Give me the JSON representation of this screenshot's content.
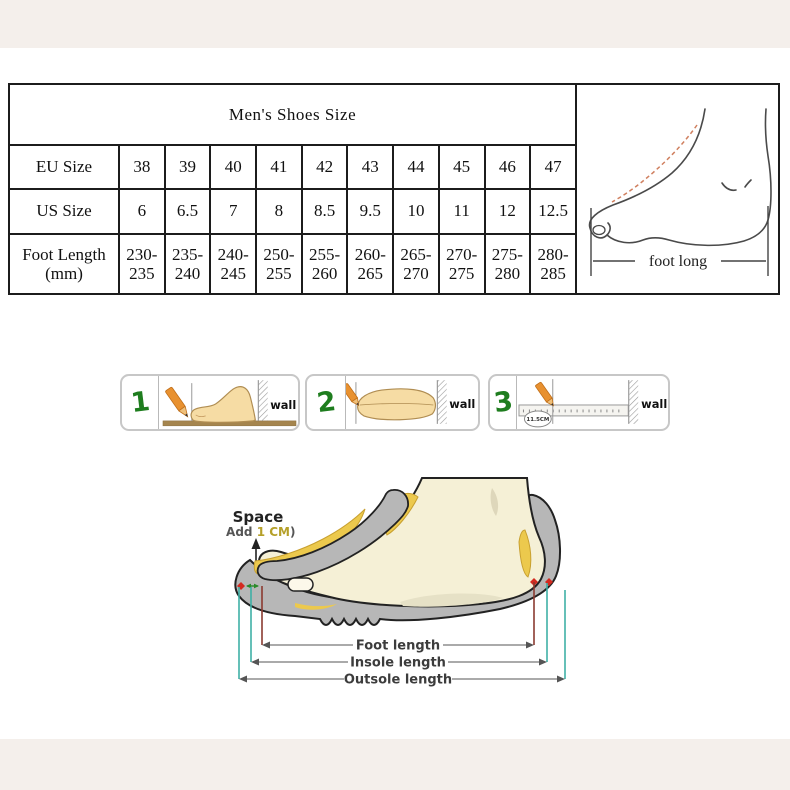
{
  "size_table": {
    "title": "Men's Shoes Size",
    "rows": {
      "eu": {
        "label": "EU Size",
        "values": [
          "38",
          "39",
          "40",
          "41",
          "42",
          "43",
          "44",
          "45",
          "46",
          "47"
        ]
      },
      "us": {
        "label": "US Size",
        "values": [
          "6",
          "6.5",
          "7",
          "8",
          "8.5",
          "9.5",
          "10",
          "11",
          "12",
          "12.5"
        ]
      },
      "foot": {
        "label_line1": "Foot Length",
        "label_line2": "(mm)",
        "top": [
          "230-",
          "235-",
          "240-",
          "250-",
          "255-",
          "260-",
          "265-",
          "270-",
          "275-",
          "280-"
        ],
        "bottom": [
          "235",
          "240",
          "245",
          "255",
          "260",
          "265",
          "270",
          "275",
          "280",
          "285"
        ]
      }
    },
    "foot_figure_label": "foot long"
  },
  "measure_steps": {
    "step1": {
      "number": "1",
      "wall_label": "wall"
    },
    "step2": {
      "number": "2",
      "wall_label": "wall"
    },
    "step3": {
      "number": "3",
      "wall_label": "wall",
      "ruler_note": "11.5CM"
    }
  },
  "shoe_diagram": {
    "space_label": "Space",
    "space_note_prefix": "(Add ",
    "space_note_value": "1 CM",
    "space_note_suffix": ")",
    "labels": {
      "foot": "Foot length",
      "insole": "Insole length",
      "outsole": "Outsole length"
    }
  },
  "colors": {
    "band_beige": "#f4efeb",
    "accent_green": "#1e7d1e",
    "teal_line": "#3fb0a6",
    "red_line": "#8b3a30",
    "marker_red": "#d42a20",
    "note_olive": "#b5a029",
    "shoe_gray": "#b7b7b7",
    "insole_yellow": "#ecc94d",
    "foot_cream": "#f5f0d6",
    "pencil_orange": "#e89130"
  }
}
